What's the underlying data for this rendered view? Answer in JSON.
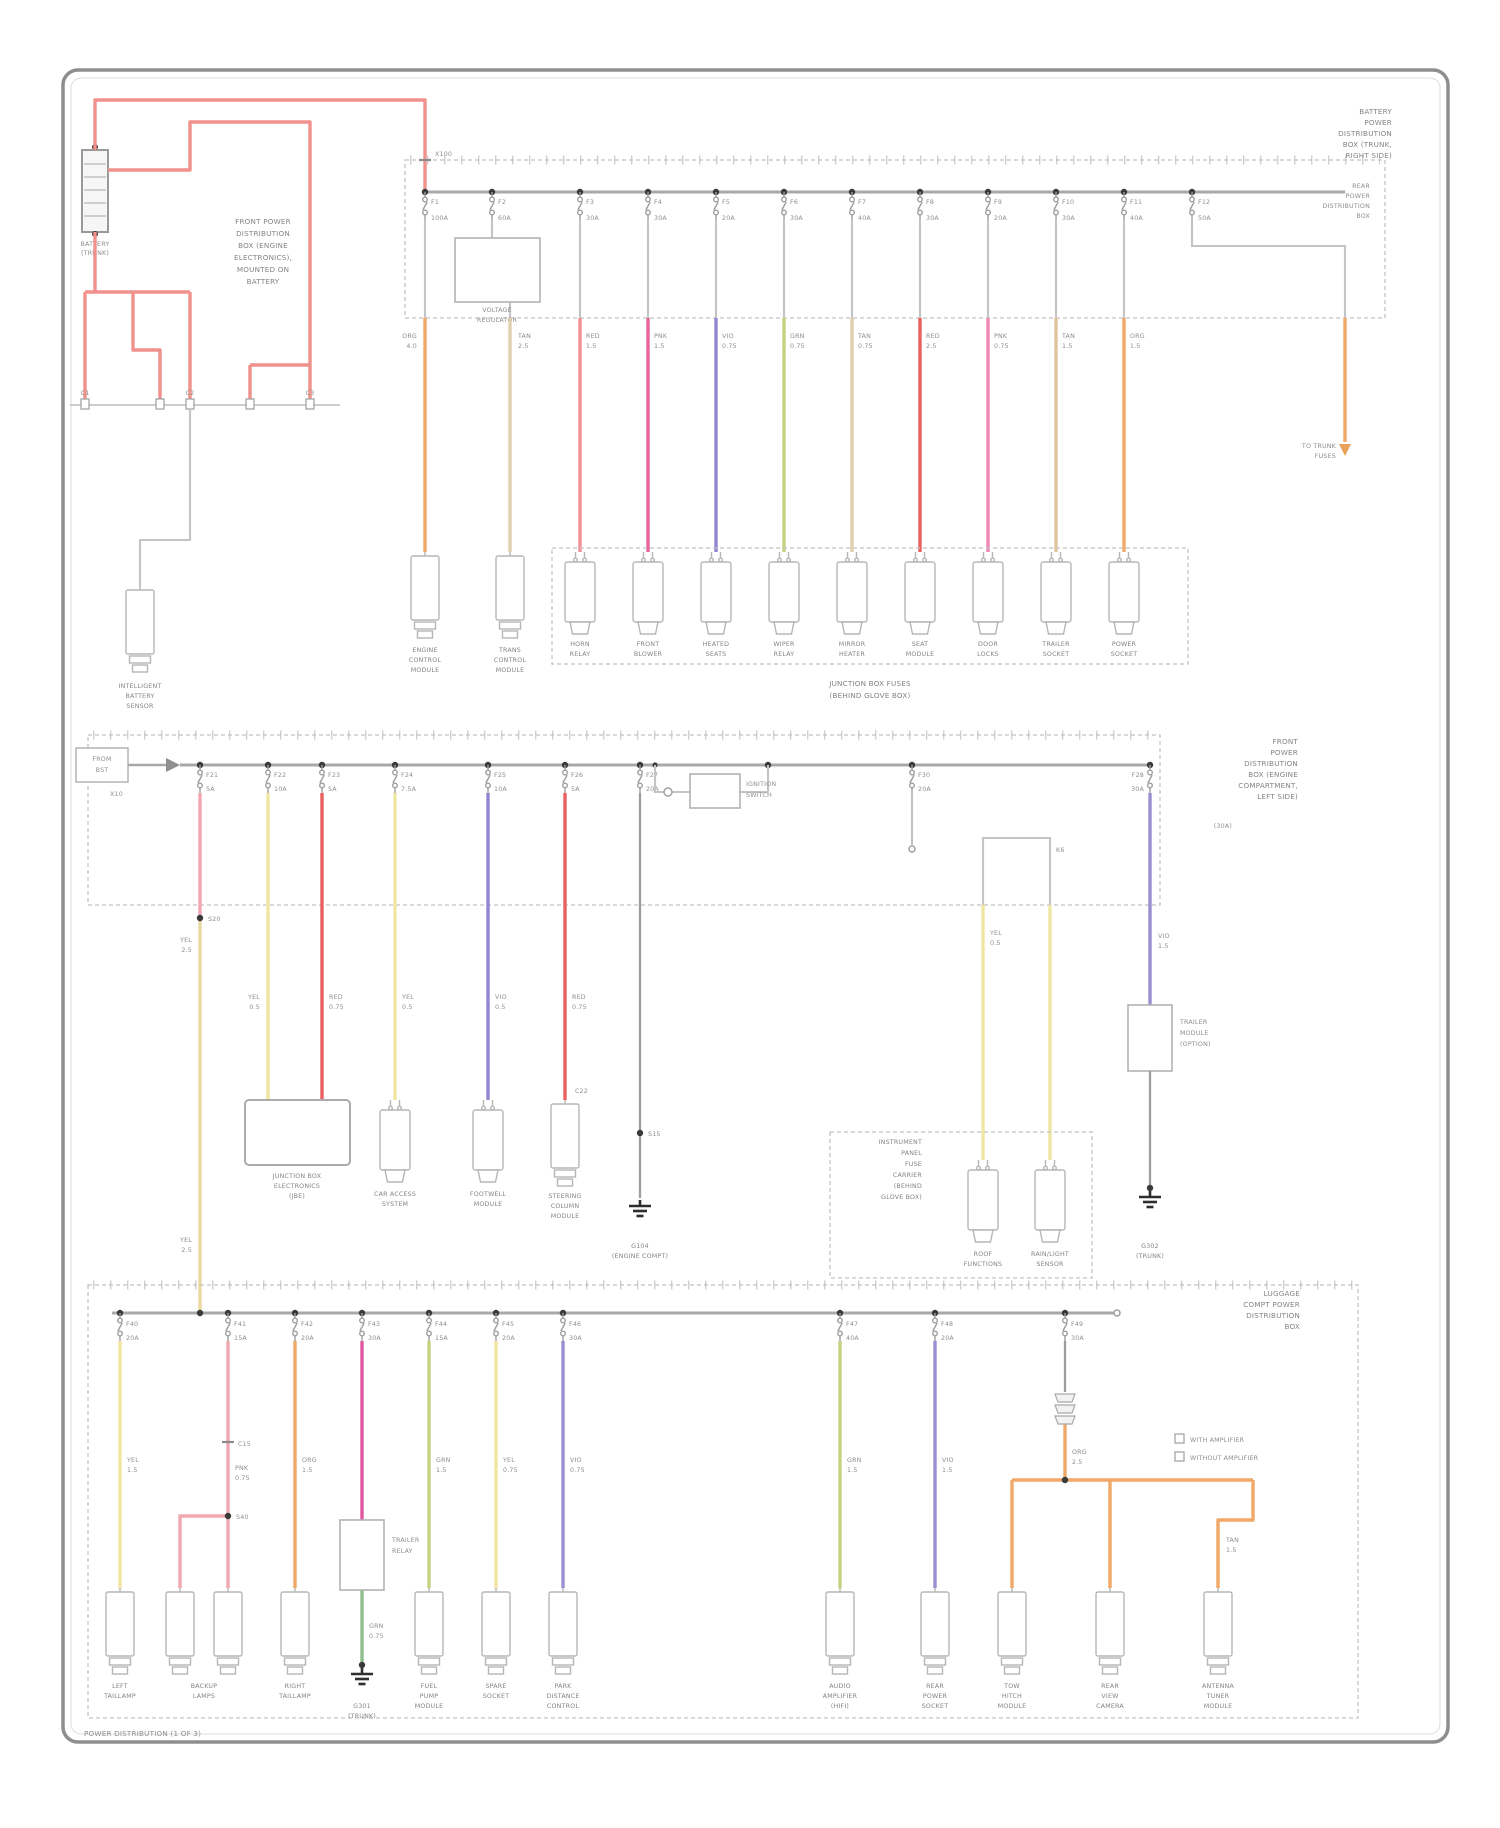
{
  "palette": {
    "wire_red": "#f0918c",
    "wire_red2": "#ea5f5f",
    "wire_crimson": "#e8659c",
    "wire_pink": "#ef87b5",
    "wire_magenta": "#e257a2",
    "wire_orange": "#f0a868",
    "wire_tan": "#dfd0ae",
    "wire_yellow": "#f0e6a2",
    "wire_yellow_green": "#c3d37f",
    "wire_green": "#8fbf8f",
    "wire_violet": "#9186cf",
    "wire_gray": "#c4c4c4",
    "bus_gray": "#a8a8a8",
    "dot_black": "#3a3a3a",
    "border_gray": "#8e8e8e"
  },
  "footer": "POWER DISTRIBUTION (1 OF 3)",
  "battery": {
    "l1": "BATTERY",
    "l2": "(TRUNK)"
  },
  "topnote": {
    "l1": "FRONT POWER",
    "l2": "DISTRIBUTION",
    "l3": "BOX (ENGINE",
    "l4": "ELECTRONICS),",
    "l5": "MOUNTED ON",
    "l6": "BATTERY"
  },
  "connrow": {
    "a": "C1",
    "b": "C2",
    "c": "C3"
  },
  "ibs": {
    "l1": "INTELLIGENT",
    "l2": "BATTERY",
    "l3": "SENSOR"
  },
  "band1": {
    "conn": "X100",
    "hdr": {
      "l1": "BATTERY",
      "l2": "POWER",
      "l3": "DISTRIBUTION",
      "l4": "BOX (TRUNK,",
      "l5": "RIGHT SIDE)"
    },
    "sub": {
      "l1": "REAR",
      "l2": "POWER",
      "l3": "DISTRIBUTION",
      "l4": "BOX"
    },
    "gen": {
      "l1": "VOLTAGE",
      "l2": "REGULATOR"
    },
    "ecm": {
      "l1": "ENGINE",
      "l2": "CONTROL",
      "l3": "MODULE"
    },
    "tcm": {
      "l1": "TRANS",
      "l2": "CONTROL",
      "l3": "MODULE"
    },
    "to": {
      "l1": "TO TRUNK",
      "l2": "FUSES"
    },
    "fuses": [
      {
        "f": "F1",
        "a": "100A"
      },
      {
        "f": "F2",
        "a": "60A"
      },
      {
        "f": "F3",
        "a": "30A"
      },
      {
        "f": "F4",
        "a": "30A"
      },
      {
        "f": "F5",
        "a": "20A"
      },
      {
        "f": "F6",
        "a": "30A"
      },
      {
        "f": "F7",
        "a": "40A"
      },
      {
        "f": "F8",
        "a": "30A"
      },
      {
        "f": "F9",
        "a": "20A"
      },
      {
        "f": "F10",
        "a": "30A"
      },
      {
        "f": "F11",
        "a": "40A"
      },
      {
        "f": "F12",
        "a": "50A"
      }
    ],
    "wires": [
      {
        "c": "ORG",
        "g": "4.0"
      },
      {
        "c": "TAN",
        "g": "2.5"
      },
      {
        "c": "RED",
        "g": "1.5"
      },
      {
        "c": "PNK",
        "g": "1.5"
      },
      {
        "c": "VIO",
        "g": "0.75"
      },
      {
        "c": "GRN",
        "g": "0.75"
      },
      {
        "c": "TAN",
        "g": "0.75"
      },
      {
        "c": "RED",
        "g": "2.5"
      },
      {
        "c": "PNK",
        "g": "0.75"
      },
      {
        "c": "TAN",
        "g": "1.5"
      },
      {
        "c": "ORG",
        "g": "1.5"
      }
    ],
    "loads": [
      {
        "l1": "HORN",
        "l2": "RELAY"
      },
      {
        "l1": "FRONT",
        "l2": "BLOWER"
      },
      {
        "l1": "HEATED",
        "l2": "SEATS"
      },
      {
        "l1": "WIPER",
        "l2": "RELAY"
      },
      {
        "l1": "MIRROR",
        "l2": "HEATER"
      },
      {
        "l1": "SEAT",
        "l2": "MODULE"
      },
      {
        "l1": "DOOR",
        "l2": "LOCKS"
      },
      {
        "l1": "TRAILER",
        "l2": "SOCKET"
      },
      {
        "l1": "POWER",
        "l2": "SOCKET"
      }
    ],
    "caption": {
      "l1": "JUNCTION BOX FUSES",
      "l2": "(BEHIND GLOVE BOX)"
    }
  },
  "band2": {
    "src": {
      "l1": "FROM",
      "l2": "BST"
    },
    "tag": "X10",
    "hdr": {
      "l1": "FRONT",
      "l2": "POWER",
      "l3": "DISTRIBUTION",
      "l4": "BOX (ENGINE",
      "l5": "COMPARTMENT,",
      "l6": "LEFT SIDE)"
    },
    "amp": "(30A)",
    "fuses": [
      {
        "f": "F21",
        "a": "5A"
      },
      {
        "f": "F22",
        "a": "10A"
      },
      {
        "f": "F23",
        "a": "5A"
      },
      {
        "f": "F24",
        "a": "7.5A"
      },
      {
        "f": "F25",
        "a": "10A"
      },
      {
        "f": "F26",
        "a": "5A"
      },
      {
        "f": "F27",
        "a": "20A"
      },
      {
        "f": "F28",
        "a": "30A"
      }
    ],
    "midfuse": {
      "f": "F30",
      "a": "20A"
    },
    "k": "K6",
    "s1": "S20",
    "s2": "S15",
    "c22": "C22",
    "sw": {
      "l1": "IGNITION",
      "l2": "SWITCH"
    },
    "wires": {
      "feed": {
        "c": "YEL",
        "g": "2.5"
      },
      "w268": {
        "c": "YEL",
        "g": "0.5"
      },
      "w322": {
        "c": "RED",
        "g": "0.75"
      },
      "w395": {
        "c": "YEL",
        "g": "0.5"
      },
      "w488": {
        "c": "VIO",
        "g": "0.5"
      },
      "w565": {
        "c": "RED",
        "g": "0.75"
      },
      "wyel": {
        "c": "YEL",
        "g": "0.5"
      },
      "wvio": {
        "c": "VIO",
        "g": "1.5"
      }
    },
    "loads": {
      "jbe": {
        "l1": "JUNCTION BOX",
        "l2": "ELECTRONICS",
        "l3": "(JBE)"
      },
      "cas": {
        "l1": "CAR ACCESS",
        "l2": "SYSTEM"
      },
      "fwm": {
        "l1": "FOOTWELL",
        "l2": "MODULE"
      },
      "scm": {
        "l1": "STEERING",
        "l2": "COLUMN",
        "l3": "MODULE"
      }
    },
    "gnd1": {
      "l1": "G104",
      "l2": "(ENGINE COMPT)"
    },
    "panel": {
      "l1": "INSTRUMENT",
      "l2": "PANEL",
      "l3": "FUSE",
      "l4": "CARRIER",
      "l5": "(BEHIND",
      "l6": "GLOVE BOX)"
    },
    "pload1": {
      "l1": "ROOF",
      "l2": "FUNCTIONS"
    },
    "pload2": {
      "l1": "RAIN/LIGHT",
      "l2": "SENSOR"
    },
    "trailer": {
      "l1": "TRAILER",
      "l2": "MODULE",
      "l3": "(OPTION)"
    },
    "gnd2": {
      "l1": "G302",
      "l2": "(TRUNK)"
    }
  },
  "band3": {
    "hdr": {
      "l1": "LUGGAGE",
      "l2": "COMPT POWER",
      "l3": "DISTRIBUTION",
      "l4": "BOX"
    },
    "fuses": [
      {
        "f": "F40",
        "a": "20A"
      },
      {
        "f": "F41",
        "a": "15A"
      },
      {
        "f": "F42",
        "a": "20A"
      },
      {
        "f": "F43",
        "a": "30A"
      },
      {
        "f": "F44",
        "a": "15A"
      },
      {
        "f": "F45",
        "a": "20A"
      },
      {
        "f": "F46",
        "a": "30A"
      },
      {
        "f": "F47",
        "a": "40A"
      },
      {
        "f": "F48",
        "a": "20A"
      },
      {
        "f": "F49",
        "a": "30A"
      }
    ],
    "c15": "C15",
    "s40": "S40",
    "relay": {
      "l1": "TRAILER",
      "l2": "RELAY"
    },
    "gnd3": {
      "l1": "G301",
      "l2": "(TRUNK)"
    },
    "wires": {
      "w120": {
        "c": "YEL",
        "g": "1.5"
      },
      "w228": {
        "c": "PNK",
        "g": "0.75"
      },
      "w295": {
        "c": "ORG",
        "g": "1.5"
      },
      "wgrn": {
        "c": "GRN",
        "g": "0.75"
      },
      "w429": {
        "c": "GRN",
        "g": "1.5"
      },
      "w496": {
        "c": "YEL",
        "g": "0.75"
      },
      "w563": {
        "c": "VIO",
        "g": "0.75"
      },
      "w840": {
        "c": "GRN",
        "g": "1.5"
      },
      "w935": {
        "c": "VIO",
        "g": "1.5"
      },
      "w1065": {
        "c": "ORG",
        "g": "2.5"
      },
      "wtan": {
        "c": "TAN",
        "g": "1.5"
      }
    },
    "loads": {
      "l120": {
        "l1": "LEFT",
        "l2": "TAILLAMP"
      },
      "l204": {
        "l1": "BACKUP",
        "l2": "LAMPS"
      },
      "l295": {
        "l1": "RIGHT",
        "l2": "TAILLAMP"
      },
      "l429": {
        "l1": "FUEL",
        "l2": "PUMP",
        "l3": "MODULE"
      },
      "l496": {
        "l1": "SPARE",
        "l2": "SOCKET"
      },
      "l563": {
        "l1": "PARK",
        "l2": "DISTANCE",
        "l3": "CONTROL"
      },
      "l840": {
        "l1": "AUDIO",
        "l2": "AMPLIFIER",
        "l3": "(HIFI)"
      },
      "l935": {
        "l1": "REAR",
        "l2": "POWER",
        "l3": "SOCKET"
      },
      "l1012": {
        "l1": "TOW",
        "l2": "HITCH",
        "l3": "MODULE"
      },
      "l1110": {
        "l1": "REAR",
        "l2": "VIEW",
        "l3": "CAMERA"
      },
      "l1218": {
        "l1": "ANTENNA",
        "l2": "TUNER",
        "l3": "MODULE"
      }
    },
    "legend": {
      "r1": "WITH AMPLIFIER",
      "r2": "WITHOUT AMPLIFIER"
    }
  }
}
